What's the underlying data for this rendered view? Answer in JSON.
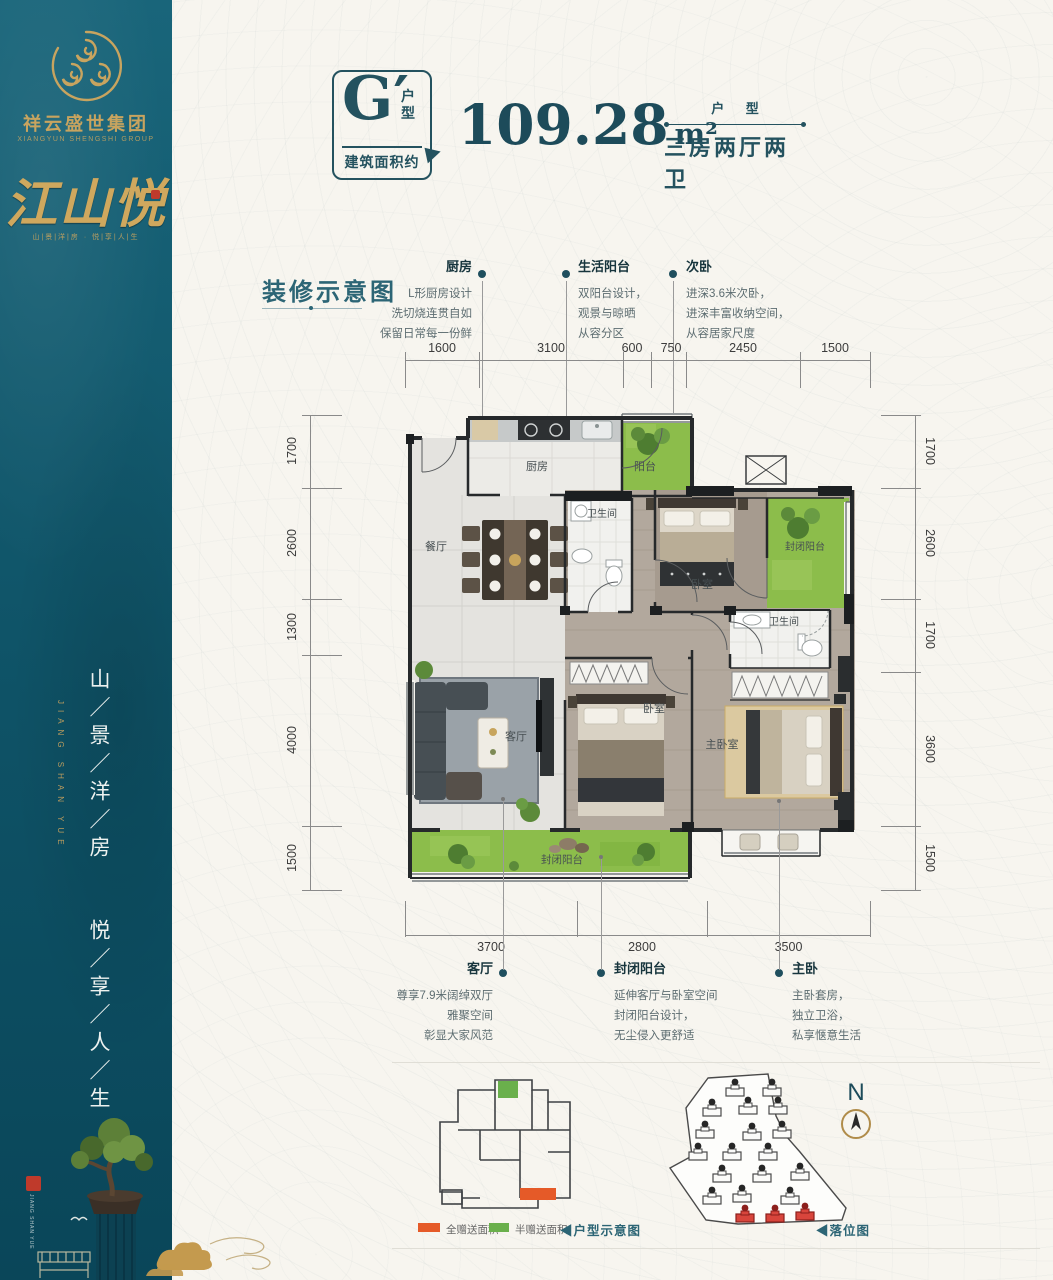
{
  "colors": {
    "teal": "#24525f",
    "teal_dark": "#1d4b5a",
    "gold": "#c8a45f",
    "plan_green": "#8cbd4b",
    "legend_orange": "#e55a28",
    "legend_green": "#6ab04c",
    "seal_red": "#bf3a2b"
  },
  "sidebar": {
    "group_name": "祥云盛世集团",
    "group_name_en": "XIANGYUN SHENGSHI GROUP",
    "brand": "江山悦",
    "brand_sub": "山|景|洋|房 · 悦|享|人|生",
    "slogan_col1": "山／景／洋／房",
    "slogan_col2": "悦／享／人／生",
    "slogan_en": "JIANG SHAN YUE"
  },
  "header": {
    "unit": "G′",
    "unit_tag_1": "户",
    "unit_tag_2": "型",
    "area_label": "建筑面积约",
    "area_value": "109.28",
    "area_unit": "m²",
    "layout_label": "户 型",
    "layout_value": "三房两厅两卫"
  },
  "section_title": "装修示意图",
  "top_callouts": [
    {
      "title": "厨房",
      "lines": [
        "L形厨房设计",
        "洗切烧连贯自如",
        "保留日常每一份鲜"
      ]
    },
    {
      "title": "生活阳台",
      "lines": [
        "双阳台设计，",
        "观景与晾晒",
        "从容分区"
      ]
    },
    {
      "title": "次卧",
      "lines": [
        "进深3.6米次卧，",
        "进深丰富收纳空间，",
        "从容居家尺度"
      ]
    }
  ],
  "bottom_callouts": [
    {
      "title": "客厅",
      "lines": [
        "尊享7.9米阔绰双厅",
        "雅聚空间",
        "彰显大家风范"
      ]
    },
    {
      "title": "封闭阳台",
      "lines": [
        "延伸客厅与卧室空间",
        "封闭阳台设计，",
        "无尘侵入更舒适"
      ]
    },
    {
      "title": "主卧",
      "lines": [
        "主卧套房，",
        "独立卫浴，",
        "私享惬意生活"
      ]
    }
  ],
  "dims": {
    "top": [
      "1600",
      "3100",
      "600",
      "750",
      "2450",
      "1500"
    ],
    "left": [
      "1700",
      "2600",
      "1300",
      "4000",
      "1500"
    ],
    "right": [
      "1700",
      "2600",
      "1700",
      "3600",
      "1500"
    ],
    "bottom": [
      "3700",
      "2800",
      "3500"
    ]
  },
  "rooms": {
    "kitchen": "厨房",
    "balcony": "阳台",
    "bath1": "卫生间",
    "bedroom1": "卧室",
    "enclosed_right": "封闭阳台",
    "dining": "餐厅",
    "bath2": "卫生间",
    "living": "客厅",
    "bedroom2": "卧室",
    "master": "主卧室",
    "enclosed_bottom": "封闭阳台"
  },
  "footer": {
    "legend_full": "全赠送面积",
    "legend_half": "半赠送面积",
    "unit_diagram_label": "◀户型示意图",
    "site_diagram_label": "◀落位图",
    "north": "N"
  }
}
